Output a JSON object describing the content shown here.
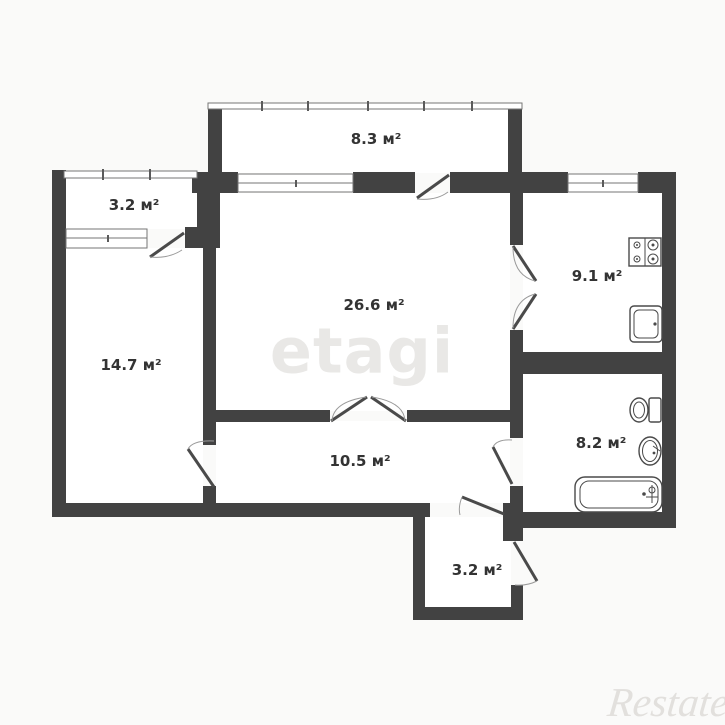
{
  "floor_plan": {
    "rooms": [
      {
        "name": "balcony-top",
        "area_label": "8.3 м²"
      },
      {
        "name": "balcony-left",
        "area_label": "3.2 м²"
      },
      {
        "name": "living-room",
        "area_label": "26.6 м²"
      },
      {
        "name": "kitchen",
        "area_label": "9.1 м²"
      },
      {
        "name": "bedroom",
        "area_label": "14.7 м²"
      },
      {
        "name": "bathroom",
        "area_label": "8.2 м²"
      },
      {
        "name": "hallway",
        "area_label": "10.5 м²"
      },
      {
        "name": "entry-vestibule",
        "area_label": "3.2 м²"
      }
    ],
    "fixtures": [
      "stove-icon",
      "kitchen-sink-icon",
      "toilet-icon",
      "washbasin-icon",
      "bathtub-icon"
    ]
  },
  "watermarks": {
    "agency": "etagi",
    "portal": "Restate"
  },
  "colors": {
    "wall": "#424242",
    "room-fill": "#ffffff",
    "window-line": "#757575",
    "door-line": "#4a4a4a",
    "label-text": "#333333",
    "watermark-agency": "#e9e8e6",
    "watermark-portal": "#e2e0dd",
    "background": "#fafaf9"
  }
}
